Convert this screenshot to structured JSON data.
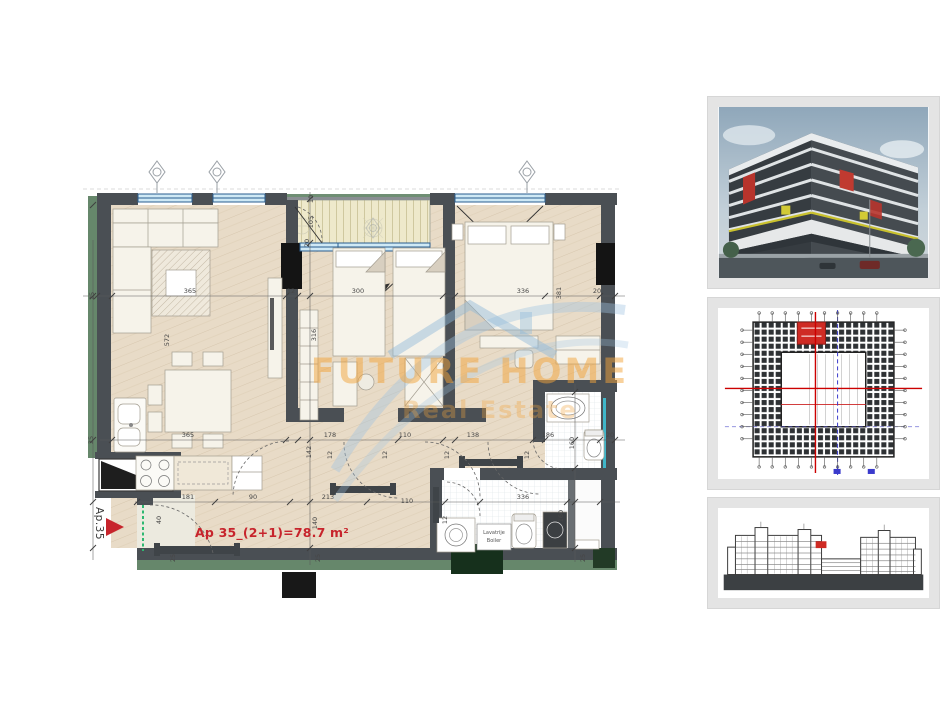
{
  "colors": {
    "unit_red": "#c7242c",
    "watermark_orange": "#f2a43c",
    "watermark_blue": "#9fc3e0",
    "highlight_red": "#cf2b24",
    "wall_gray": "#4a4f54",
    "facade_green": "#66876b"
  },
  "watermark": {
    "title": "FUTURE HOME",
    "subtitle": "Real Estate"
  },
  "floor_plan": {
    "apartment_label": "Ap 35_(2+1)=78.7 m²",
    "entry_marker": "Ap.35",
    "laundry_label_line1": "Lavatrije",
    "laundry_label_line2": "Boiler",
    "dimension_labels": [
      {
        "t": "365",
        "x": 190,
        "y": 293,
        "r": 0
      },
      {
        "t": "12",
        "x": 291,
        "y": 293,
        "r": 0
      },
      {
        "t": "300",
        "x": 358,
        "y": 293,
        "r": 0
      },
      {
        "t": "336",
        "x": 523,
        "y": 293,
        "r": 0
      },
      {
        "t": "20",
        "x": 597,
        "y": 293,
        "r": 0
      },
      {
        "t": "25",
        "x": 94,
        "y": 296,
        "r": -90
      },
      {
        "t": "381",
        "x": 561,
        "y": 293,
        "r": -90
      },
      {
        "t": "10",
        "x": 313,
        "y": 199,
        "r": -90
      },
      {
        "t": "105",
        "x": 313,
        "y": 222,
        "r": -90
      },
      {
        "t": "20",
        "x": 309,
        "y": 243,
        "r": -90
      },
      {
        "t": "572",
        "x": 169,
        "y": 340,
        "r": -90
      },
      {
        "t": "316",
        "x": 316,
        "y": 335,
        "r": -90
      },
      {
        "t": "365",
        "x": 188,
        "y": 437,
        "r": 0
      },
      {
        "t": "178",
        "x": 330,
        "y": 437,
        "r": 0
      },
      {
        "t": "110",
        "x": 405,
        "y": 437,
        "r": 0
      },
      {
        "t": "138",
        "x": 473,
        "y": 437,
        "r": 0
      },
      {
        "t": "186",
        "x": 548,
        "y": 437,
        "r": 0
      },
      {
        "t": "20",
        "x": 610,
        "y": 437,
        "r": 0
      },
      {
        "t": "160",
        "x": 574,
        "y": 443,
        "r": -90
      },
      {
        "t": "142",
        "x": 311,
        "y": 452,
        "r": -90
      },
      {
        "t": "12",
        "x": 332,
        "y": 455,
        "r": -90
      },
      {
        "t": "12",
        "x": 387,
        "y": 455,
        "r": -90
      },
      {
        "t": "12",
        "x": 449,
        "y": 455,
        "r": -90
      },
      {
        "t": "12",
        "x": 529,
        "y": 455,
        "r": -90
      },
      {
        "t": "181",
        "x": 188,
        "y": 499,
        "r": 0
      },
      {
        "t": "90",
        "x": 253,
        "y": 499,
        "r": 0
      },
      {
        "t": "213",
        "x": 328,
        "y": 499,
        "r": 0
      },
      {
        "t": "110",
        "x": 407,
        "y": 503,
        "r": 0
      },
      {
        "t": "336",
        "x": 523,
        "y": 499,
        "r": 0
      },
      {
        "t": "160",
        "x": 563,
        "y": 516,
        "r": -90
      },
      {
        "t": "12",
        "x": 447,
        "y": 520,
        "r": -90
      },
      {
        "t": "140",
        "x": 317,
        "y": 523,
        "r": -90
      },
      {
        "t": "40",
        "x": 161,
        "y": 520,
        "r": -90
      },
      {
        "t": "25",
        "x": 175,
        "y": 558,
        "r": -90
      },
      {
        "t": "25",
        "x": 320,
        "y": 558,
        "r": -90
      },
      {
        "t": "25",
        "x": 585,
        "y": 558,
        "r": -90
      },
      {
        "t": "25",
        "x": 93,
        "y": 440,
        "r": -90
      }
    ]
  },
  "thumbnails": [
    {
      "name": "building-render"
    },
    {
      "name": "site-plan"
    },
    {
      "name": "building-elevation"
    }
  ]
}
